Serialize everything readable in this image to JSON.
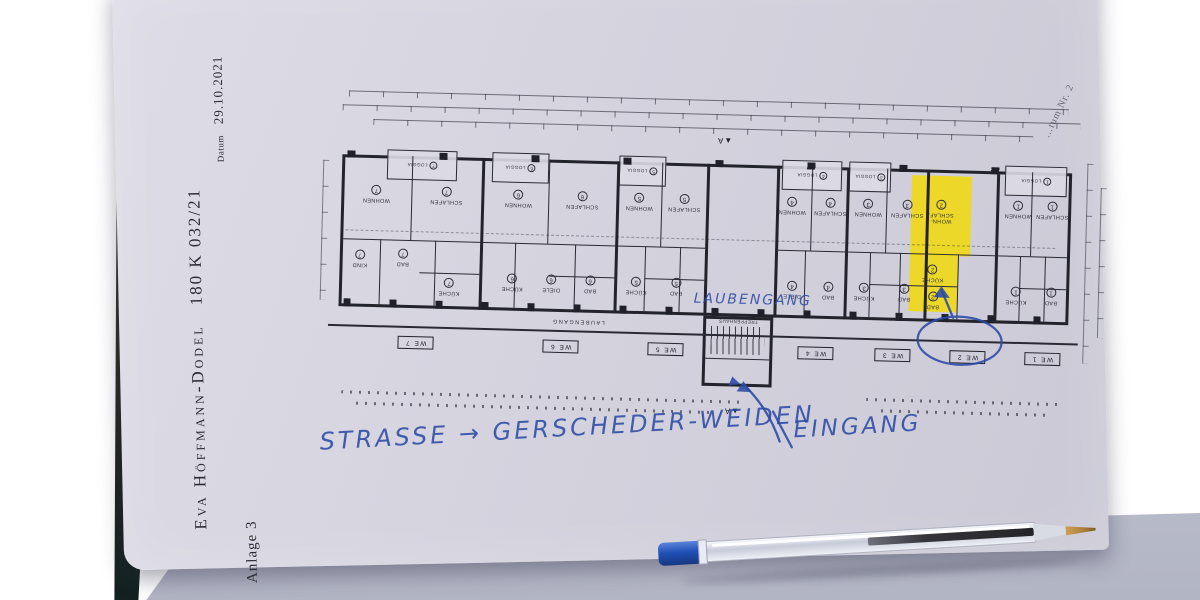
{
  "paper": {
    "margin": {
      "name": "Eva Höffmann-Dodel",
      "case_number": "180 K  032/21",
      "date_label": "Datum",
      "date_value": "29.10.2021",
      "attachment": "Anlage 3",
      "corner_note": "…tum Nr. 2"
    }
  },
  "plan": {
    "printed_labels": {
      "laubengang": "LAUBENGANG",
      "treppenhaus": "TREPPENHAUS",
      "section_letter": "A",
      "section_triangle": "▲"
    },
    "we_labels": [
      "WE 7",
      "WE 6",
      "WE 5",
      "WE 4",
      "WE 3",
      "WE 2",
      "WE 1"
    ],
    "loggias": [
      {
        "label": "LOGGIA",
        "num": "7"
      },
      {
        "label": "LOGGIA",
        "num": "6"
      },
      {
        "label": "LOGGIA",
        "num": "5"
      },
      {
        "label": "LOGGIA",
        "num": "4"
      },
      {
        "label": "LOGGIA",
        "num": "3"
      },
      {
        "label": "LOGGIA",
        "num": "1"
      }
    ],
    "rooms": [
      {
        "label": "WOHNEN",
        "num": "7"
      },
      {
        "label": "SCHLAFEN",
        "num": "7"
      },
      {
        "label": "KIND",
        "num": "7"
      },
      {
        "label": "BAD",
        "num": "7"
      },
      {
        "label": "KÜCHE",
        "num": "7"
      },
      {
        "label": "WOHNEN",
        "num": "6"
      },
      {
        "label": "SCHLAFEN",
        "num": "6"
      },
      {
        "label": "KÜCHE",
        "num": "6"
      },
      {
        "label": "DIELE",
        "num": "6"
      },
      {
        "label": "BAD",
        "num": "6"
      },
      {
        "label": "WOHNEN",
        "num": "5"
      },
      {
        "label": "SCHLAFEN",
        "num": "5"
      },
      {
        "label": "KÜCHE",
        "num": "5"
      },
      {
        "label": "BAD",
        "num": "5"
      },
      {
        "label": "WOHNEN",
        "num": "4"
      },
      {
        "label": "SCHLAFEN",
        "num": "4"
      },
      {
        "label": "DIELE",
        "num": "4"
      },
      {
        "label": "BAD",
        "num": "4"
      },
      {
        "label": "WOHNEN",
        "num": "3"
      },
      {
        "label": "SCHLAFEN",
        "num": "3"
      },
      {
        "label": "KÜCHE",
        "num": "3"
      },
      {
        "label": "BAD",
        "num": "3"
      },
      {
        "label": "KÜCHE",
        "num": "2"
      },
      {
        "label": "BAD",
        "num": "2"
      },
      {
        "label": "WOHNEN",
        "num": "1"
      },
      {
        "label": "SCHLAFEN",
        "num": "1"
      },
      {
        "label": "KÜCHE",
        "num": "1"
      },
      {
        "label": "BAD",
        "num": "1"
      }
    ],
    "highlight": {
      "unit": "WE 2",
      "label": "WOHN-SCHLAF.",
      "num": "2",
      "color": "#f0d915"
    }
  },
  "handwriting": {
    "ink_color": "#2b4ba6",
    "laubengang": "LAUBENGANG",
    "street": "STRASSE → GERSCHEDER-WEIDEN",
    "eingang": "EINGANG"
  }
}
